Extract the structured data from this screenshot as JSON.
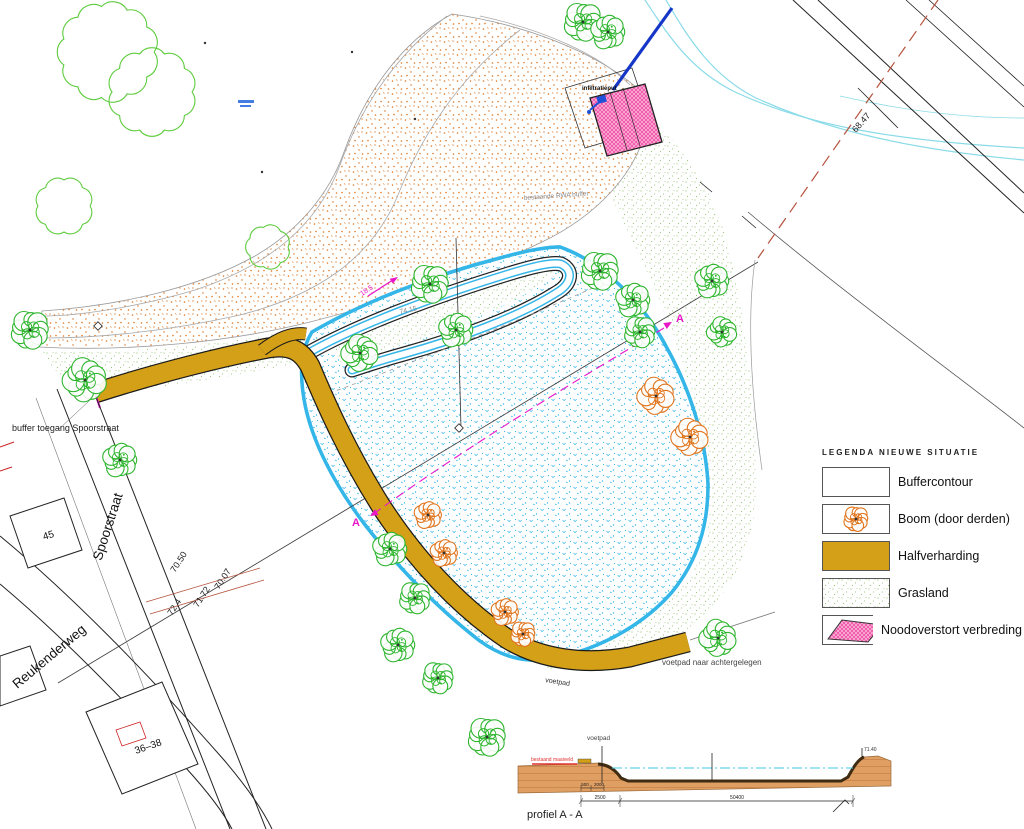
{
  "title": "inrichtingsplan waterbuffer",
  "legend": {
    "title": "LEGENDA NIEUWE SITUATIE",
    "items": [
      {
        "label": "Buffercontour",
        "type": "buffer"
      },
      {
        "label": "Boom (door derden)",
        "type": "boom"
      },
      {
        "label": "Halfverharding",
        "type": "halfverharding"
      },
      {
        "label": "Grasland",
        "type": "grasland"
      },
      {
        "label": "Noodoverstort verbreding",
        "type": "noodoverstort"
      }
    ]
  },
  "colors": {
    "orange": "#e0761e",
    "cyan": "#35b6e8",
    "tree_green": "#2db52d",
    "grass": "#98c478",
    "ochre": "#d4a017",
    "pink": "#ee3f9e",
    "magenta": "#e817c8",
    "blue": "#1c3ccc",
    "red": "#cc2222",
    "red_brown": "#b5523c",
    "earth": "#df9f63"
  },
  "annotations": [
    {
      "t": "buffer toegang Spoorstraat",
      "x": 12,
      "y": 431,
      "s": 9,
      "c": "#222"
    },
    {
      "t": "Spoorstraat",
      "x": 112,
      "y": 528,
      "s": 13.5,
      "c": "#111",
      "r": -72,
      "a": "middle"
    },
    {
      "t": "Reukenderweg",
      "x": 52,
      "y": 660,
      "s": 13.5,
      "c": "#111",
      "r": -40,
      "a": "middle"
    },
    {
      "t": "45",
      "x": 44,
      "y": 540,
      "s": 10,
      "c": "#111",
      "r": -17
    },
    {
      "t": "36–38",
      "x": 136,
      "y": 754,
      "s": 10,
      "c": "#111",
      "r": -19
    },
    {
      "t": "bestaande RWA buffer",
      "x": 524,
      "y": 200,
      "s": 6.5,
      "c": "#8a8a8a",
      "r": -4
    },
    {
      "t": "voetpad naar achtergelegen",
      "x": 662,
      "y": 665,
      "s": 8,
      "c": "#444"
    },
    {
      "t": "voetpad",
      "x": 545,
      "y": 682,
      "s": 7,
      "c": "#333",
      "r": 9
    },
    {
      "t": "68.47",
      "x": 856,
      "y": 133,
      "s": 9,
      "c": "#222",
      "r": -49
    },
    {
      "t": "70.50",
      "x": 175,
      "y": 573,
      "s": 9,
      "c": "#222",
      "r": -57
    },
    {
      "t": "70.07",
      "x": 219,
      "y": 590,
      "s": 9,
      "c": "#222",
      "r": -57
    },
    {
      "t": "72.4",
      "x": 172,
      "y": 616,
      "s": 9,
      "c": "#222",
      "r": -57
    },
    {
      "t": "71.72",
      "x": 198,
      "y": 608,
      "s": 9,
      "c": "#222",
      "r": -57
    },
    {
      "t": "74.15",
      "x": 400,
      "y": 314,
      "s": 7,
      "c": "#888",
      "r": -12
    },
    {
      "t": "A",
      "x": 676,
      "y": 322,
      "s": 11,
      "c": "#e817c8",
      "w": "bold"
    },
    {
      "t": "A",
      "x": 352,
      "y": 526,
      "s": 11,
      "c": "#e817c8",
      "w": "bold"
    },
    {
      "t": "18.5",
      "x": 362,
      "y": 296,
      "s": 7,
      "c": "#e817c8",
      "r": -33
    },
    {
      "t": "infiltratieput",
      "x": 582,
      "y": 90,
      "s": 6,
      "c": "#111",
      "w": "bold"
    },
    {
      "t": "voetpad",
      "x": 587,
      "y": 740,
      "s": 6.5,
      "c": "#444"
    },
    {
      "t": "bestaand maaiveld",
      "x": 531,
      "y": 761,
      "s": 5,
      "c": "#e03030"
    },
    {
      "t": "71.40",
      "x": 864,
      "y": 751,
      "s": 5,
      "c": "#333"
    },
    {
      "t": "profiel A - A",
      "x": 527,
      "y": 818,
      "s": 11,
      "c": "#222"
    },
    {
      "t": "500",
      "x": 585,
      "y": 786,
      "s": 4.5,
      "c": "#222",
      "a": "middle"
    },
    {
      "t": "2000",
      "x": 599,
      "y": 786,
      "s": 4.5,
      "c": "#222",
      "a": "middle"
    },
    {
      "t": "2500",
      "x": 600,
      "y": 799,
      "s": 5,
      "c": "#222",
      "a": "middle"
    },
    {
      "t": "50400",
      "x": 737,
      "y": 799,
      "s": 5,
      "c": "#222",
      "a": "middle"
    }
  ],
  "trees": {
    "green": [
      {
        "x": 583,
        "y": 22,
        "r": 17
      },
      {
        "x": 608,
        "y": 32,
        "r": 15
      },
      {
        "x": 30,
        "y": 330,
        "r": 17
      },
      {
        "x": 85,
        "y": 380,
        "r": 19
      },
      {
        "x": 120,
        "y": 460,
        "r": 15
      },
      {
        "x": 360,
        "y": 353,
        "r": 16
      },
      {
        "x": 430,
        "y": 284,
        "r": 17
      },
      {
        "x": 456,
        "y": 330,
        "r": 15
      },
      {
        "x": 600,
        "y": 271,
        "r": 17
      },
      {
        "x": 633,
        "y": 300,
        "r": 15
      },
      {
        "x": 640,
        "y": 332,
        "r": 14
      },
      {
        "x": 712,
        "y": 281,
        "r": 15
      },
      {
        "x": 722,
        "y": 332,
        "r": 13
      },
      {
        "x": 390,
        "y": 549,
        "r": 15
      },
      {
        "x": 415,
        "y": 598,
        "r": 14
      },
      {
        "x": 398,
        "y": 645,
        "r": 15
      },
      {
        "x": 438,
        "y": 678,
        "r": 14
      },
      {
        "x": 487,
        "y": 737,
        "r": 17
      },
      {
        "x": 718,
        "y": 638,
        "r": 16
      }
    ],
    "orange": [
      {
        "x": 656,
        "y": 396,
        "r": 16
      },
      {
        "x": 690,
        "y": 437,
        "r": 16
      },
      {
        "x": 428,
        "y": 515,
        "r": 12
      },
      {
        "x": 444,
        "y": 553,
        "r": 12
      },
      {
        "x": 505,
        "y": 612,
        "r": 12
      },
      {
        "x": 523,
        "y": 634,
        "r": 11
      }
    ]
  }
}
